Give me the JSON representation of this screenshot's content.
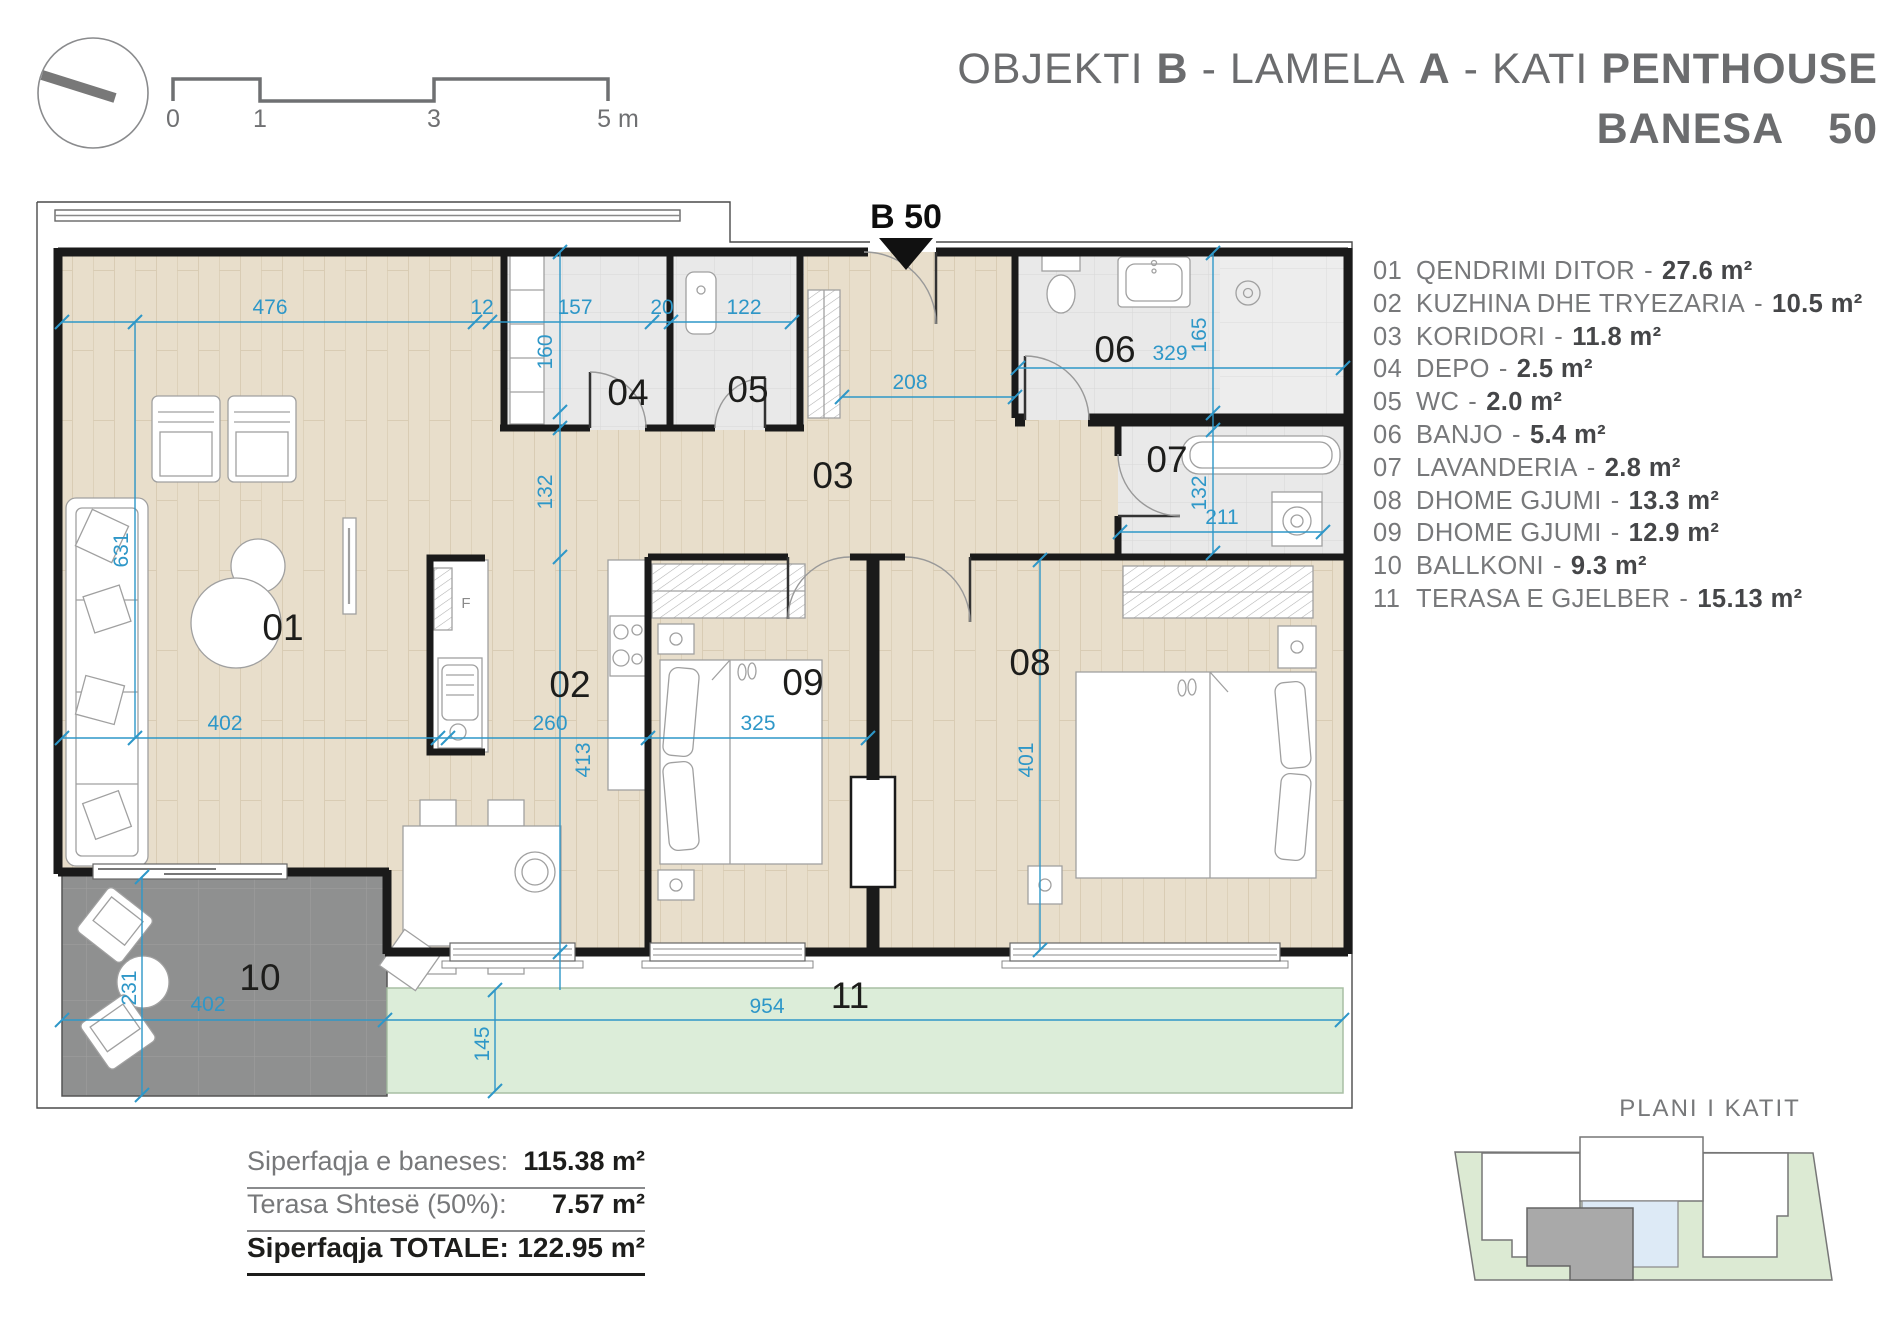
{
  "header": {
    "title": {
      "t1": "OBJEKTI",
      "b1": "B",
      "d1": "-",
      "t2": "LAMELA",
      "b2": "A",
      "d2": "-",
      "t3": "KATI",
      "b3": "PENTHOUSE",
      "line2_label": "BANESA",
      "line2_number": "50"
    }
  },
  "scale_bar": {
    "labels": [
      "0",
      "1",
      "3",
      "5 m"
    ]
  },
  "plan": {
    "marker": "B 50",
    "room_labels": {
      "r01": "01",
      "r02": "02",
      "r03": "03",
      "r04": "04",
      "r05": "05",
      "r06": "06",
      "r07": "07",
      "r08": "08",
      "r09": "09",
      "r10": "10",
      "r11": "11"
    },
    "dims": {
      "d476": "476",
      "d12": "12",
      "d157": "157",
      "d20": "20",
      "d122": "122",
      "d160": "160",
      "d132a": "132",
      "d208": "208",
      "d329": "329",
      "d165": "165",
      "d132b": "132",
      "d211": "211",
      "d631": "631",
      "d402a": "402",
      "d260": "260",
      "d413": "413",
      "d325": "325",
      "d401": "401",
      "d231": "231",
      "d402b": "402",
      "d145": "145",
      "d954": "954"
    },
    "fridge_label": "F"
  },
  "legend": {
    "separator": "-",
    "items": [
      {
        "num": "01",
        "name": "QENDRIMI DITOR",
        "area": "27.6 m²"
      },
      {
        "num": "02",
        "name": "KUZHINA DHE TRYEZARIA",
        "area": "10.5 m²"
      },
      {
        "num": "03",
        "name": "KORIDORI",
        "area": "11.8 m²"
      },
      {
        "num": "04",
        "name": "DEPO",
        "area": "2.5 m²"
      },
      {
        "num": "05",
        "name": "WC",
        "area": "2.0 m²"
      },
      {
        "num": "06",
        "name": "BANJO",
        "area": "5.4 m²"
      },
      {
        "num": "07",
        "name": "LAVANDERIA",
        "area": "2.8 m²"
      },
      {
        "num": "08",
        "name": "DHOME GJUMI",
        "area": "13.3 m²"
      },
      {
        "num": "09",
        "name": "DHOME GJUMI",
        "area": "12.9 m²"
      },
      {
        "num": "10",
        "name": "BALLKONI",
        "area": "9.3 m²"
      },
      {
        "num": "11",
        "name": "TERASA E GJELBER",
        "area": "15.13 m²"
      }
    ]
  },
  "totals": {
    "rows": [
      {
        "label": "Siperfaqja e baneses:",
        "value": "115.38 m²"
      },
      {
        "label": "Terasa Shtesë (50%):",
        "value": "7.57 m²"
      },
      {
        "label": "Siperfaqja TOTALE:",
        "value": "122.95 m²"
      }
    ]
  },
  "key_plan": {
    "title": "PLANI I KATIT"
  },
  "colors": {
    "dim_blue": "#2E97C8",
    "wood": "#E8DECB",
    "tile_gray": "#E9E9E9",
    "balcony_gray": "#8F9090",
    "terrace_green": "#DCEDD9",
    "wall": "#1A1A1A",
    "text_gray": "#77787A",
    "text_dark": "#1D1D1B"
  }
}
